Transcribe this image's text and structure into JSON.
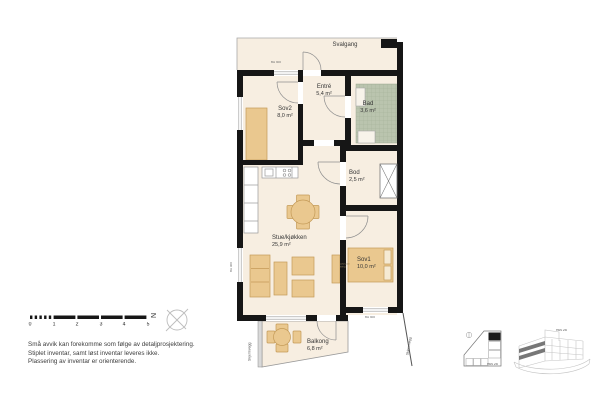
{
  "colors": {
    "floor": "#f7eee1",
    "furniture": "#eac88f",
    "furniture_border": "#c49a57",
    "bath_tile": "#bac4ae",
    "wall": "#161616",
    "thin_line": "#999999"
  },
  "plan": {
    "svalgang_label": "Svalgang",
    "rooms": [
      {
        "id": "entre",
        "name": "Entré",
        "area": "5,4 m²"
      },
      {
        "id": "bad",
        "name": "Bad",
        "area": "3,6 m²"
      },
      {
        "id": "sov2",
        "name": "Sov2",
        "area": "8,0 m²"
      },
      {
        "id": "bod",
        "name": "Bod",
        "area": "2,5 m²"
      },
      {
        "id": "stue",
        "name": "Stue/kjøkken",
        "area": "25,9 m²"
      },
      {
        "id": "sov1",
        "name": "Sov1",
        "area": "10,0 m²"
      },
      {
        "id": "balkong",
        "name": "Balkong",
        "area": "6,8 m²"
      }
    ],
    "annotations": {
      "bh_top": "BH 900",
      "bh_left": "BH 900",
      "bh_bottom": "BH 900",
      "skjermvegg_left": "Skjermvegg",
      "skjermvegg_right": "Skjermvegg",
      "bed_size": "180x200 seng"
    }
  },
  "scale_bar": {
    "ticks": [
      "0",
      "1",
      "2",
      "3",
      "4",
      "5"
    ]
  },
  "compass": {
    "north": "N"
  },
  "disclaimer": {
    "line1": "Små avvik kan forekomme som følge av detaljprosjektering.",
    "line2": "Stiplet inventar, samt løst inventar leveres ikke.",
    "line3": "Plassering av inventar er orienterende."
  },
  "key_plan": {
    "label": "Hus 2B"
  },
  "building_view": {
    "label": "Hus 2B"
  }
}
